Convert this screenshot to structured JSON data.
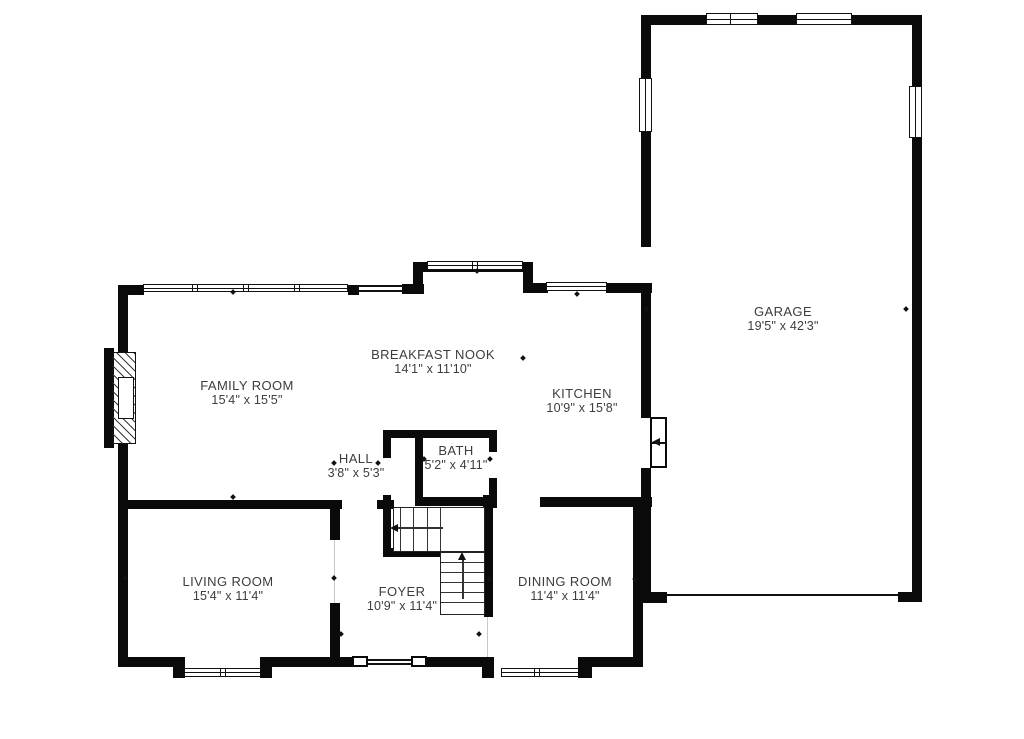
{
  "floorplan": {
    "background_color": "#ffffff",
    "wall_color": "#0a0a0a",
    "text_color": "#3d3d3d",
    "rooms": [
      {
        "id": "family-room",
        "label": "FAMILY ROOM",
        "dims": "15'4\" x 15'5\"",
        "cx": 247,
        "cy": 393
      },
      {
        "id": "breakfast-nook",
        "label": "BREAKFAST NOOK",
        "dims": "14'1\" x 11'10\"",
        "cx": 433,
        "cy": 362
      },
      {
        "id": "kitchen",
        "label": "KITCHEN",
        "dims": "10'9\" x 15'8\"",
        "cx": 582,
        "cy": 401
      },
      {
        "id": "hall",
        "label": "HALL",
        "dims": "3'8\" x 5'3\"",
        "cx": 356,
        "cy": 466
      },
      {
        "id": "bath",
        "label": "BATH",
        "dims": "5'2\" x 4'11\"",
        "cx": 456,
        "cy": 458
      },
      {
        "id": "living-room",
        "label": "LIVING ROOM",
        "dims": "15'4\" x 11'4\"",
        "cx": 228,
        "cy": 589
      },
      {
        "id": "foyer",
        "label": "FOYER",
        "dims": "10'9\" x 11'4\"",
        "cx": 402,
        "cy": 599
      },
      {
        "id": "dining-room",
        "label": "DINING ROOM",
        "dims": "11'4\" x 11'4\"",
        "cx": 565,
        "cy": 589
      },
      {
        "id": "garage",
        "label": "GARAGE",
        "dims": "19'5\" x 42'3\"",
        "cx": 783,
        "cy": 319
      }
    ],
    "walls": [
      [
        643,
        15,
        279,
        10
      ],
      [
        912,
        15,
        10,
        587
      ],
      [
        641,
        15,
        10,
        65
      ],
      [
        641,
        130,
        10,
        117
      ],
      [
        641,
        283,
        10,
        135
      ],
      [
        641,
        468,
        10,
        124
      ],
      [
        641,
        592,
        26,
        10
      ],
      [
        898,
        592,
        24,
        10
      ],
      [
        118,
        285,
        26,
        10
      ],
      [
        348,
        285,
        11,
        10
      ],
      [
        402,
        284,
        22,
        10
      ],
      [
        413,
        262,
        10,
        32
      ],
      [
        413,
        262,
        120,
        10
      ],
      [
        523,
        262,
        10,
        31
      ],
      [
        533,
        283,
        15,
        10
      ],
      [
        606,
        283,
        46,
        10
      ],
      [
        118,
        285,
        10,
        68
      ],
      [
        118,
        443,
        10,
        224
      ],
      [
        104,
        348,
        10,
        100
      ],
      [
        118,
        657,
        57,
        10
      ],
      [
        173,
        657,
        12,
        21
      ],
      [
        260,
        657,
        12,
        21
      ],
      [
        272,
        657,
        80,
        10
      ],
      [
        425,
        657,
        59,
        10
      ],
      [
        482,
        657,
        12,
        21
      ],
      [
        578,
        657,
        14,
        21
      ],
      [
        590,
        657,
        53,
        10
      ],
      [
        633,
        497,
        10,
        170
      ],
      [
        643,
        593,
        24,
        10
      ],
      [
        118,
        500,
        224,
        9
      ],
      [
        330,
        502,
        10,
        38
      ],
      [
        330,
        603,
        10,
        54
      ],
      [
        377,
        500,
        17,
        9
      ],
      [
        383,
        430,
        114,
        8
      ],
      [
        383,
        430,
        8,
        28
      ],
      [
        383,
        495,
        8,
        58
      ],
      [
        383,
        548,
        57,
        9
      ],
      [
        415,
        430,
        8,
        73
      ],
      [
        489,
        430,
        8,
        22
      ],
      [
        489,
        478,
        8,
        30
      ],
      [
        415,
        497,
        82,
        9
      ],
      [
        483,
        495,
        14,
        13
      ],
      [
        484,
        505,
        9,
        112
      ],
      [
        540,
        497,
        112,
        10
      ]
    ],
    "windows": [
      {
        "x": 143,
        "y": 284,
        "w": 205,
        "h": 8,
        "o": "h",
        "div": [
          192,
          197,
          243,
          248,
          294,
          299
        ]
      },
      {
        "x": 427,
        "y": 261,
        "w": 96,
        "h": 9,
        "o": "h",
        "div": [
          472,
          477
        ]
      },
      {
        "x": 546,
        "y": 282,
        "w": 61,
        "h": 9,
        "o": "h",
        "div": []
      },
      {
        "x": 706,
        "y": 13,
        "w": 52,
        "h": 12,
        "o": "h",
        "div": [
          730
        ]
      },
      {
        "x": 796,
        "y": 13,
        "w": 56,
        "h": 12,
        "o": "h",
        "div": []
      },
      {
        "x": 639,
        "y": 78,
        "w": 13,
        "h": 54,
        "o": "v",
        "div": []
      },
      {
        "x": 909,
        "y": 86,
        "w": 13,
        "h": 52,
        "o": "v",
        "div": []
      },
      {
        "x": 184,
        "y": 668,
        "w": 77,
        "h": 9,
        "o": "h",
        "div": [
          220,
          225
        ]
      },
      {
        "x": 501,
        "y": 668,
        "w": 78,
        "h": 9,
        "o": "h",
        "div": [
          534,
          539
        ]
      }
    ],
    "lines": [
      [
        359,
        285,
        44,
        2,
        "#111"
      ],
      [
        359,
        290,
        44,
        2,
        "#111"
      ],
      [
        368,
        659,
        43,
        2,
        "#111"
      ],
      [
        368,
        663,
        43,
        2,
        "#111"
      ],
      [
        667,
        594,
        231,
        2,
        "#111"
      ],
      [
        334,
        540,
        1,
        63,
        "#c8c8c8"
      ],
      [
        487,
        617,
        1,
        40,
        "#c8c8c8"
      ]
    ],
    "jambs": [
      [
        352,
        656,
        16,
        11
      ],
      [
        411,
        656,
        16,
        11
      ]
    ],
    "fireplace": {
      "hatch": [
        112,
        352,
        24,
        92
      ],
      "firebox": [
        118,
        377,
        16,
        42
      ]
    },
    "garage_entry_door": {
      "box": [
        650,
        417,
        17,
        51
      ],
      "midline": [
        651,
        442,
        15,
        2
      ],
      "arrow": [
        652,
        438
      ]
    },
    "stairs": {
      "upper": {
        "rect": [
          393,
          507,
          92,
          45
        ],
        "treads_x": [
          400,
          413,
          427,
          440
        ],
        "arrow_line": [
          397,
          527,
          46,
          2
        ],
        "arrow_head": [
          390,
          524
        ]
      },
      "lower": {
        "rect": [
          440,
          552,
          45,
          63
        ],
        "treads_y": [
          562,
          572,
          582,
          592,
          602
        ],
        "arrow_line": [
          462,
          559,
          2,
          40
        ],
        "arrow_head": [
          458,
          552
        ]
      }
    },
    "ticks": [
      [
        233,
        292
      ],
      [
        477,
        271
      ],
      [
        577,
        294
      ],
      [
        647,
        309
      ],
      [
        906,
        309
      ],
      [
        125,
        578
      ],
      [
        334,
        578
      ],
      [
        489,
        579
      ],
      [
        635,
        579
      ],
      [
        334,
        463
      ],
      [
        378,
        463
      ],
      [
        424,
        459
      ],
      [
        490,
        459
      ],
      [
        341,
        634
      ],
      [
        479,
        634
      ],
      [
        233,
        497
      ],
      [
        523,
        358
      ]
    ]
  }
}
